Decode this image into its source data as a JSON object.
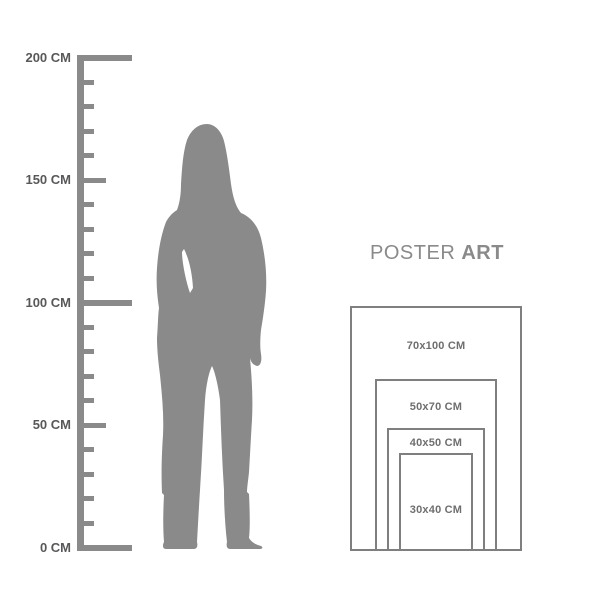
{
  "brand": {
    "name_regular": "POSTER",
    "name_bold": "ART"
  },
  "ruler": {
    "unit": "CM",
    "max_cm": 200,
    "tick_interval_cm": 10,
    "labels": [
      {
        "value": 200,
        "text": "200 CM"
      },
      {
        "value": 150,
        "text": "150 CM"
      },
      {
        "value": 100,
        "text": "100 CM"
      },
      {
        "value": 50,
        "text": "50 CM"
      },
      {
        "value": 0,
        "text": "0 CM"
      }
    ]
  },
  "poster_sizes": [
    {
      "width_cm": 70,
      "height_cm": 100,
      "label": "70x100 CM"
    },
    {
      "width_cm": 50,
      "height_cm": 70,
      "label": "50x70 CM"
    },
    {
      "width_cm": 40,
      "height_cm": 50,
      "label": "40x50 CM"
    },
    {
      "width_cm": 30,
      "height_cm": 40,
      "label": "30x40 CM"
    }
  ],
  "colors": {
    "background": "#ffffff",
    "silhouette": "#8a8a8a",
    "ruler": "#8a8a8a",
    "ruler_text": "#58585a",
    "frame_border": "#7f7f7f",
    "frame_text": "#6e6e6e",
    "brand_text": "#8a8a8a"
  }
}
